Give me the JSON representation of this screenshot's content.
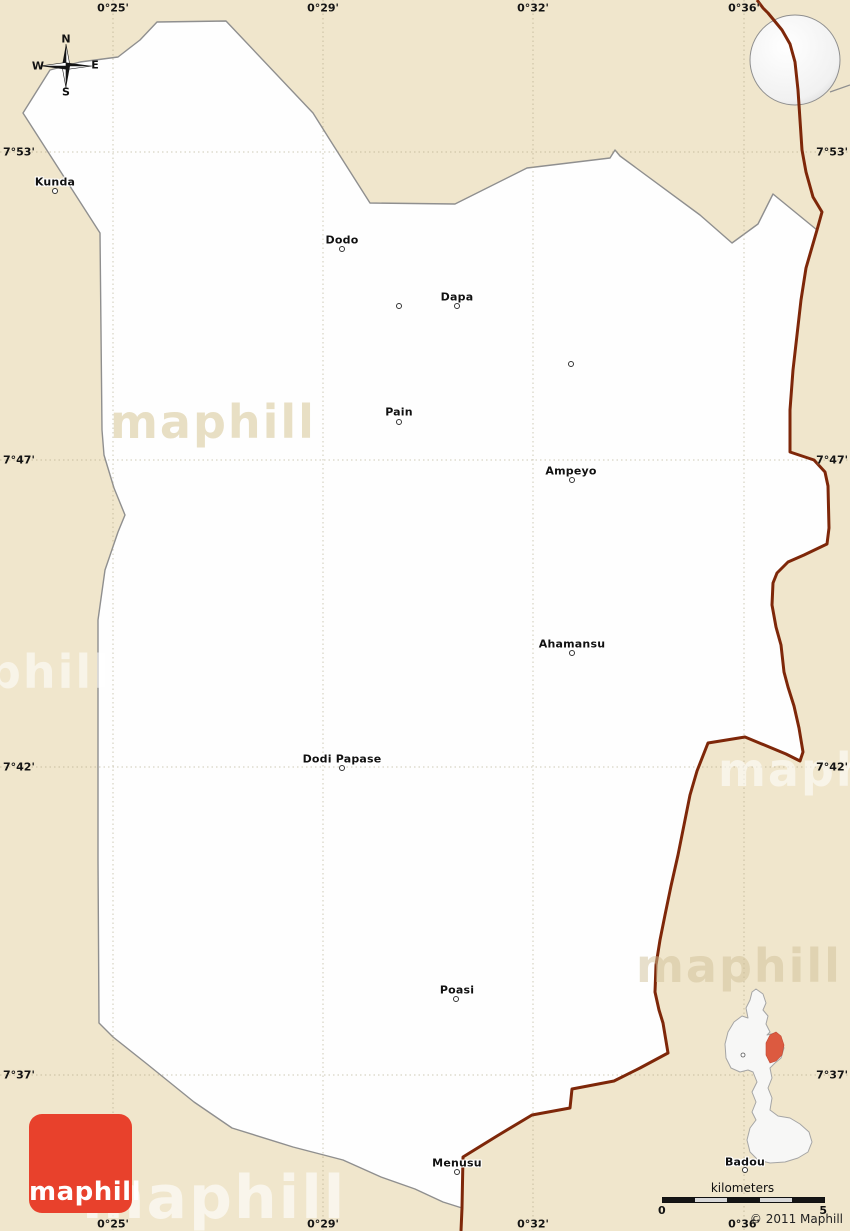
{
  "page": {
    "copyright": "© 2011 Maphill",
    "logo_text": "maphill",
    "watermark_text": "maphill"
  },
  "compass": {
    "north": "N",
    "east": "E",
    "south": "S",
    "west": "W"
  },
  "grid": {
    "meridians": [
      {
        "label": "0°25'",
        "x": 113
      },
      {
        "label": "0°29'",
        "x": 323
      },
      {
        "label": "0°32'",
        "x": 533
      },
      {
        "label": "0°36'",
        "x": 744
      }
    ],
    "parallels": [
      {
        "label": "7°53'",
        "y": 152
      },
      {
        "label": "7°47'",
        "y": 460
      },
      {
        "label": "7°42'",
        "y": 767
      },
      {
        "label": "7°37'",
        "y": 1075
      }
    ]
  },
  "places": [
    {
      "name": "Kunda",
      "lx": 55,
      "ly": 182,
      "dx": 55,
      "dy": 191
    },
    {
      "name": "Dodo",
      "lx": 342,
      "ly": 240,
      "dx": 342,
      "dy": 249
    },
    {
      "name": "Dapa",
      "lx": 457,
      "ly": 297,
      "dx": 457,
      "dy": 306
    },
    {
      "name": "Pain",
      "lx": 399,
      "ly": 412,
      "dx": 399,
      "dy": 422
    },
    {
      "name": "Ampeyo",
      "lx": 571,
      "ly": 471,
      "dx": 572,
      "dy": 480
    },
    {
      "name": "Ahamansu",
      "lx": 572,
      "ly": 644,
      "dx": 572,
      "dy": 653
    },
    {
      "name": "Dodi Papase",
      "lx": 342,
      "ly": 759,
      "dx": 342,
      "dy": 768
    },
    {
      "name": "Poasi",
      "lx": 457,
      "ly": 990,
      "dx": 456,
      "dy": 999
    },
    {
      "name": "Menusu",
      "lx": 457,
      "ly": 1163,
      "dx": 457,
      "dy": 1172
    },
    {
      "name": "Badou",
      "lx": 745,
      "ly": 1162,
      "dx": 745,
      "dy": 1170
    }
  ],
  "unlabeled_dots": [
    [
      399,
      306
    ],
    [
      571,
      364
    ]
  ],
  "scalebar": {
    "title": "kilometers",
    "min": "0",
    "max": "5",
    "segments": 5
  },
  "colors": {
    "background": "#F0E6CC",
    "district_fill": "#FEFEFE",
    "district_stroke": "#8F8F8F",
    "country_border": "#7E2709",
    "gridline": "#A89E7E",
    "logo_red": "#E8412C",
    "inset_highlight": "#DC5A40",
    "inset_fill": "#F7F7F6",
    "inset_stroke": "#A5A5A5",
    "globe_land": "#C9C9C9",
    "globe_marker": "#E8412C"
  },
  "watermarks": [
    {
      "x": 110,
      "y": 422,
      "size": 46,
      "color": "rgba(228,217,186,0.85)"
    },
    {
      "x": -95,
      "y": 672,
      "size": 46,
      "color": "rgba(255,255,255,0.55)"
    },
    {
      "x": 718,
      "y": 770,
      "size": 46,
      "color": "rgba(255,255,255,0.55)"
    },
    {
      "x": 636,
      "y": 966,
      "size": 46,
      "color": "rgba(208,192,152,0.5)"
    },
    {
      "x": 82,
      "y": 1198,
      "size": 60,
      "color": "rgba(255,255,255,0.6)"
    }
  ],
  "geometry": {
    "district_polygon": [
      [
        157,
        22
      ],
      [
        226,
        21
      ],
      [
        313,
        113
      ],
      [
        330,
        140
      ],
      [
        370,
        203
      ],
      [
        455,
        204
      ],
      [
        527,
        168
      ],
      [
        610,
        158
      ],
      [
        615,
        150
      ],
      [
        620,
        156
      ],
      [
        700,
        215
      ],
      [
        732,
        243
      ],
      [
        758,
        224
      ],
      [
        773,
        194
      ],
      [
        817,
        230
      ],
      [
        806,
        268
      ],
      [
        801,
        300
      ],
      [
        797,
        335
      ],
      [
        793,
        370
      ],
      [
        790,
        410
      ],
      [
        790,
        452
      ],
      [
        814,
        460
      ],
      [
        825,
        472
      ],
      [
        828,
        486
      ],
      [
        829,
        528
      ],
      [
        827,
        544
      ],
      [
        804,
        555
      ],
      [
        788,
        562
      ],
      [
        777,
        573
      ],
      [
        773,
        583
      ],
      [
        772,
        605
      ],
      [
        776,
        627
      ],
      [
        781,
        645
      ],
      [
        784,
        672
      ],
      [
        788,
        687
      ],
      [
        794,
        706
      ],
      [
        799,
        728
      ],
      [
        803,
        752
      ],
      [
        800,
        761
      ],
      [
        786,
        754
      ],
      [
        745,
        737
      ],
      [
        708,
        743
      ],
      [
        697,
        771
      ],
      [
        690,
        795
      ],
      [
        684,
        825
      ],
      [
        678,
        855
      ],
      [
        671,
        886
      ],
      [
        665,
        915
      ],
      [
        660,
        940
      ],
      [
        656,
        965
      ],
      [
        655,
        992
      ],
      [
        659,
        1010
      ],
      [
        663,
        1023
      ],
      [
        668,
        1053
      ],
      [
        640,
        1068
      ],
      [
        614,
        1081
      ],
      [
        572,
        1089
      ],
      [
        570,
        1108
      ],
      [
        532,
        1115
      ],
      [
        497,
        1136
      ],
      [
        463,
        1157
      ],
      [
        462,
        1208
      ],
      [
        443,
        1202
      ],
      [
        415,
        1189
      ],
      [
        381,
        1177
      ],
      [
        343,
        1160
      ],
      [
        293,
        1147
      ],
      [
        232,
        1128
      ],
      [
        194,
        1102
      ],
      [
        147,
        1064
      ],
      [
        113,
        1037
      ],
      [
        99,
        1023
      ],
      [
        98,
        860
      ],
      [
        98,
        620
      ],
      [
        105,
        570
      ],
      [
        118,
        532
      ],
      [
        125,
        515
      ],
      [
        114,
        488
      ],
      [
        104,
        455
      ],
      [
        102,
        430
      ],
      [
        100,
        233
      ],
      [
        23,
        113
      ],
      [
        50,
        70
      ],
      [
        80,
        62
      ],
      [
        118,
        57
      ],
      [
        140,
        40
      ]
    ],
    "country_border": [
      [
        757,
        0
      ],
      [
        763,
        8
      ],
      [
        768,
        13
      ],
      [
        782,
        30
      ],
      [
        790,
        44
      ],
      [
        795,
        62
      ],
      [
        798,
        90
      ],
      [
        800,
        120
      ],
      [
        802,
        150
      ],
      [
        806,
        172
      ],
      [
        813,
        197
      ],
      [
        822,
        212
      ],
      [
        817,
        230
      ],
      [
        806,
        268
      ],
      [
        801,
        300
      ],
      [
        797,
        335
      ],
      [
        793,
        370
      ],
      [
        790,
        410
      ],
      [
        790,
        452
      ],
      [
        814,
        460
      ],
      [
        825,
        472
      ],
      [
        828,
        486
      ],
      [
        829,
        528
      ],
      [
        827,
        544
      ],
      [
        804,
        555
      ],
      [
        788,
        562
      ],
      [
        777,
        573
      ],
      [
        773,
        583
      ],
      [
        772,
        605
      ],
      [
        776,
        627
      ],
      [
        781,
        645
      ],
      [
        784,
        672
      ],
      [
        788,
        687
      ],
      [
        794,
        706
      ],
      [
        799,
        728
      ],
      [
        803,
        752
      ],
      [
        800,
        761
      ],
      [
        786,
        754
      ],
      [
        745,
        737
      ],
      [
        708,
        743
      ],
      [
        697,
        771
      ],
      [
        690,
        795
      ],
      [
        684,
        825
      ],
      [
        678,
        855
      ],
      [
        671,
        886
      ],
      [
        665,
        915
      ],
      [
        660,
        940
      ],
      [
        656,
        965
      ],
      [
        655,
        992
      ],
      [
        659,
        1010
      ],
      [
        663,
        1023
      ],
      [
        668,
        1053
      ],
      [
        640,
        1068
      ],
      [
        614,
        1081
      ],
      [
        572,
        1089
      ],
      [
        570,
        1108
      ],
      [
        532,
        1115
      ],
      [
        497,
        1136
      ],
      [
        463,
        1157
      ],
      [
        462,
        1208
      ],
      [
        461,
        1231
      ]
    ],
    "stray_boundary": [
      [
        830,
        92
      ],
      [
        850,
        85
      ]
    ],
    "globe": {
      "cx": 795,
      "cy": 60,
      "r": 45,
      "marker": [
        787,
        54,
        7,
        7
      ]
    },
    "compass": {
      "cx": 66,
      "cy": 66,
      "n": [
        66,
        39
      ],
      "e": [
        95,
        65
      ],
      "s": [
        66,
        92
      ],
      "w": [
        38,
        66
      ]
    },
    "inset_outline": "M 756,989 L 763,994 L 766,1003 L 763,1010 L 768,1016 L 766,1024 L 770,1032 L 767,1035 L 775,1033 L 781,1038 L 784,1048 L 781,1058 L 775,1063 L 770,1068 L 772,1078 L 768,1088 L 772,1098 L 770,1110 L 778,1116 L 790,1118 L 800,1124 L 809,1132 L 812,1142 L 808,1152 L 798,1158 L 785,1162 L 770,1163 L 758,1160 L 750,1152 L 747,1140 L 750,1128 L 756,1120 L 752,1112 L 756,1102 L 752,1092 L 757,1082 L 753,1072 L 748,1070 L 740,1072 L 731,1068 L 726,1058 L 725,1044 L 728,1032 L 734,1022 L 742,1016 L 748,1018 L 746,1008 L 750,1000 L 752,992 Z",
    "inset_highlight": "M 770,1035 L 776,1032 L 781,1036 L 784,1045 L 782,1055 L 776,1061 L 770,1063 L 766,1055 L 766,1043 Z",
    "inset_dot": [
      743,
      1055
    ]
  }
}
